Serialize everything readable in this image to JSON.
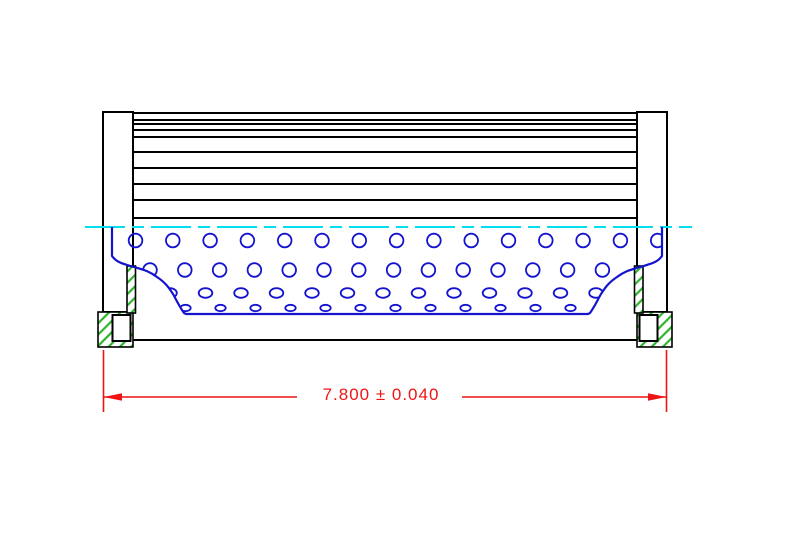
{
  "dimension": {
    "text": "7.800 ± 0.040"
  },
  "colors": {
    "line": "#000000",
    "tube": "#1414cf",
    "centerline": "#00dfef",
    "dimension": "#ef1414",
    "hatch": "#2db42d",
    "background": "#ffffff"
  },
  "media": {
    "pleat_line_ys": [
      120,
      124,
      130,
      137,
      152,
      168,
      184,
      200
    ],
    "left_x": 133,
    "right_x": 637
  },
  "perforations": {
    "rows": [
      {
        "cy": 240.5,
        "rx": 6.8,
        "ry": 6.8,
        "x0": 135.5,
        "pitch": 37.3,
        "count": 15
      },
      {
        "cy": 270.0,
        "rx": 6.8,
        "ry": 6.8,
        "x0": 150.0,
        "pitch": 34.8,
        "count": 14
      },
      {
        "cy": 293.0,
        "rx": 6.8,
        "ry": 4.8,
        "x0": 170.0,
        "pitch": 35.5,
        "count": 13
      },
      {
        "cy": 308.0,
        "rx": 5.2,
        "ry": 3.2,
        "x0": 185.5,
        "pitch": 35.0,
        "count": 12
      }
    ]
  }
}
